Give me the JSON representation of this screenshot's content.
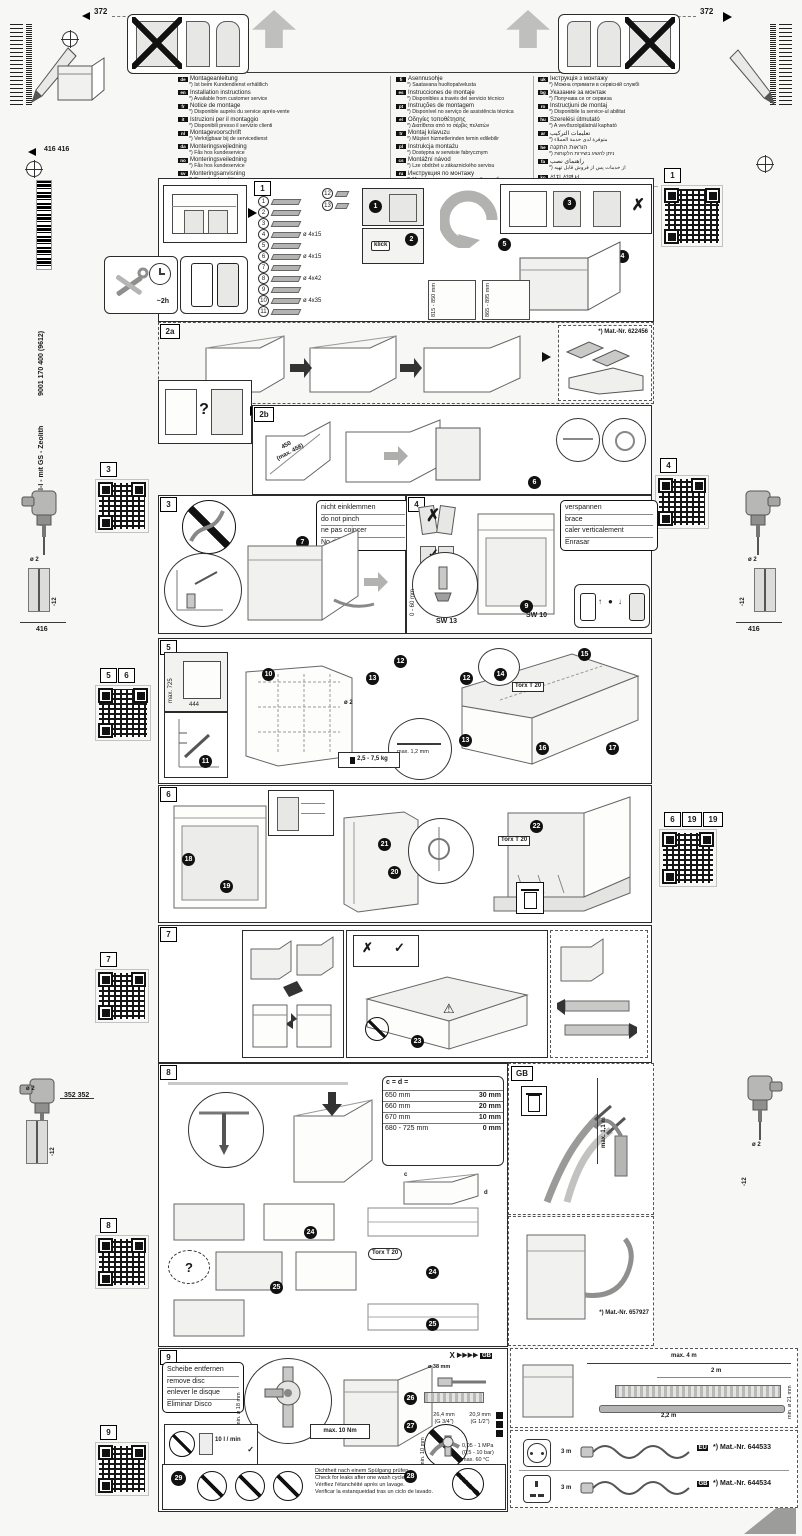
{
  "icons": {
    "x": "✗",
    "check": "✓",
    "play": "▶",
    "q": "?",
    "warn": "⚠",
    "up": "↑",
    "down": "↓",
    "dot": "●"
  },
  "header": {
    "dim_left": "372",
    "dim_right": "372"
  },
  "sidebar_left": {
    "dim_pair": "416 416",
    "product": "GV 440 Voll-I - mit GS - Zeolith",
    "docnum": "9001 170 400 (9612)",
    "drill1": {
      "dia": "ø 2",
      "depth": "-12",
      "base": "416"
    },
    "drill2": {
      "dia": "ø 2",
      "depth": "-12",
      "pair": "352 352"
    },
    "sq3": "3",
    "sq5": "5",
    "sq6": "6",
    "sq7": "7",
    "sq8": "8",
    "sq9": "9"
  },
  "sidebar_right": {
    "sq1": "1",
    "sq4": "4",
    "sq6": "6",
    "sq19a": "19",
    "sq19b": "19",
    "drill1": {
      "dia": "ø 2",
      "depth": "-12",
      "base": "416"
    },
    "drill2": {
      "dia": "ø 2",
      "depth": "-12"
    }
  },
  "languages": {
    "col1": [
      {
        "code": "de",
        "title": "Montageanleitung",
        "note": "*) Ist beim Kundendienst erhältlich"
      },
      {
        "code": "en",
        "title": "Installation instructions",
        "note": "*) Available from customer service"
      },
      {
        "code": "fr",
        "title": "Notice de montage",
        "note": "*) Disponible auprès du service après-vente"
      },
      {
        "code": "it",
        "title": "Istruzioni per il montaggio",
        "note": "*) Disponibili presso il servizio clienti"
      },
      {
        "code": "nl",
        "title": "Montagevoorschrift",
        "note": "*) Verkrijgbaar bij de servicedienst"
      },
      {
        "code": "da",
        "title": "Monteringsvejledning",
        "note": "*) Fås hos kundeservice"
      },
      {
        "code": "no",
        "title": "Monteringsveiledning",
        "note": "*) Fås hos kundeservice"
      },
      {
        "code": "sv",
        "title": "Monteringsanvisning",
        "note": "*) Finns hos kundtjänsten"
      }
    ],
    "col2": [
      {
        "code": "fi",
        "title": "Asennusohje",
        "note": "*) Saatavana huoltopalvelusta"
      },
      {
        "code": "es",
        "title": "Instrucciones de montaje",
        "note": "*) Disponibles a través del servicio técnico"
      },
      {
        "code": "pt",
        "title": "Instruções de montagem",
        "note": "*) Disponível no serviço de assistência técnica"
      },
      {
        "code": "el",
        "title": "Οδηγίες τοποθέτησης",
        "note": "*) Διατίθεται από το σέρβις πελατών"
      },
      {
        "code": "tr",
        "title": "Montaj kılavuzu",
        "note": "*) Müşteri hizmetlerinden temin edilebilir"
      },
      {
        "code": "pl",
        "title": "Instrukcja montażu",
        "note": "*) Dostępna w serwisie fabrycznym"
      },
      {
        "code": "cs",
        "title": "Montážní návod",
        "note": "*) Lze obdržet u zákaznického servisu"
      },
      {
        "code": "ru",
        "title": "Инструкция по монтажу",
        "note": "*) Можно получить в сервисной службе"
      }
    ],
    "col3": [
      {
        "code": "uk",
        "title": "Інструкція з монтажу",
        "note": "*) Можна отримати в сервісній службі"
      },
      {
        "code": "bg",
        "title": "Указание за монтаж",
        "note": "*) Получава се от сервиза"
      },
      {
        "code": "ro",
        "title": "Instrucţiuni de montaj",
        "note": "*) Disponibile la service-ul abilitat"
      },
      {
        "code": "hu",
        "title": "Szerelési útmutató",
        "note": "*) A vevőszolgálatnál kapható"
      },
      {
        "code": "ar",
        "title": "تعليمات التركيب",
        "note": "*) متوفرة لدى خدمة العملاء"
      },
      {
        "code": "he",
        "title": "הוראות התקנה",
        "note": "*) ניתן להשיג בשירות הלקוחות"
      },
      {
        "code": "fa",
        "title": "راهنمای نصب",
        "note": "*) از خدمات پس از فروش قابل تهیه"
      },
      {
        "code": "ko",
        "title": "설치 설명서",
        "note": "*) 고객 서비스 센터에서 구입 가능"
      },
      {
        "code": "zh",
        "title": "安装说明",
        "note": "*) 可向客户服务部门索取"
      },
      {
        "code": "ja",
        "title": "取付説明書",
        "note": "*) カスタマーサービスで入手可能"
      }
    ]
  },
  "steps": {
    "s1": {
      "label": "1",
      "time": "~2h",
      "klick": "klick",
      "dim_a": "815 - 850 mm",
      "dim_b": "865 - 895 mm",
      "parts": [
        {
          "n": "1",
          "screw": ""
        },
        {
          "n": "2",
          "screw": ""
        },
        {
          "n": "3",
          "screw": ""
        },
        {
          "n": "4",
          "screw": "ø 4x15"
        },
        {
          "n": "5",
          "screw": ""
        },
        {
          "n": "6",
          "screw": "ø 4x15"
        },
        {
          "n": "7",
          "screw": ""
        },
        {
          "n": "8",
          "screw": "ø 4x42"
        },
        {
          "n": "9",
          "screw": ""
        },
        {
          "n": "10",
          "screw": "ø 4x35"
        },
        {
          "n": "11",
          "screw": ""
        }
      ],
      "p12": "12",
      "p13": "13"
    },
    "s2a": {
      "label": "2a",
      "mat": "*) Mat.-Nr. 622456"
    },
    "s2b": {
      "label": "2b",
      "dim": "450",
      "dimmax": "(max. 458)"
    },
    "s3": {
      "label": "3",
      "note": [
        "nicht einklemmen",
        "do not pinch",
        "ne pas coincer",
        "No doblar"
      ]
    },
    "s4": {
      "label": "4",
      "note": [
        "verspannen",
        "brace",
        "caler verticalement",
        "Enrasar"
      ],
      "range": "0 - 60 mm",
      "sw13": "SW 13",
      "sw10": "SW 10"
    },
    "s5": {
      "label": "5",
      "max725": "max. 725",
      "dim444": "444",
      "dia": "ø 2",
      "maxgap": "max. 1,2 mm",
      "torx": "Torx T 20",
      "weight": "2,5 - 7,5 kg"
    },
    "s6": {
      "label": "6",
      "torx": "Torx T 20"
    },
    "s7": {
      "label": "7"
    },
    "s8": {
      "label": "8",
      "torx": "Torx T 20",
      "c": "c",
      "d": "d",
      "table": {
        "head": "c = d =",
        "rows": [
          [
            "650 mm",
            "30 mm"
          ],
          [
            "660 mm",
            "20 mm"
          ],
          [
            "670 mm",
            "10 mm"
          ],
          [
            "680 - 725 mm",
            "0 mm"
          ]
        ]
      }
    },
    "gb": {
      "label": "GB",
      "maxlen": "max. 1,1 m",
      "mat": "*) Mat.-Nr. 657927"
    },
    "s9": {
      "label": "9",
      "xmark": "X",
      "fwd": "▶▶▶▶",
      "gbtag": "GB",
      "note": [
        "Scheibe entfernen",
        "remove disc",
        "enlever le disque",
        "Eliminar Disco"
      ],
      "dia18": "min. ø 18 mm",
      "flow": "10 l / min",
      "torque": "max. 10 Nm",
      "dia38": "ø 38 mm",
      "g34": "26,4 mm",
      "g34b": "(G 3/4\")",
      "g12": "20,9 mm",
      "g12b": "(G 1/2\")",
      "min10": "min. 10 mm",
      "pressure": [
        "0,05 - 1 MPa",
        "(0,5 - 10 bar)",
        "max. 60 °C"
      ],
      "leak": [
        "Dichtheit nach einem Spülgang prüfen.",
        "Check for leaks after one wash cycle.",
        "Vérifiez l'étanchéité après un lavage.",
        "Verificar la estanqueidad tras un ciclo de lavado."
      ]
    },
    "bottom": {
      "max4": "max. 4 m",
      "d2": "2 m",
      "d22": "2,2 m",
      "dia21": "min. ø 21 mm",
      "rows": [
        {
          "len": "3 m",
          "code": "EU",
          "mat": "*) Mat.-Nr. 644533"
        },
        {
          "len": "3 m",
          "code": "GB",
          "mat": "*) Mat.-Nr. 644534"
        }
      ]
    }
  },
  "badges": {
    "b1": "1",
    "b2": "2",
    "b3": "3",
    "b4": "4",
    "b5": "5",
    "b6": "6",
    "b7": "7",
    "b8": "8",
    "b9": "9",
    "b10": "10",
    "b11": "11",
    "b12": "12",
    "b13": "13",
    "b14": "14",
    "b15": "15",
    "b16": "16",
    "b17": "17",
    "b18": "18",
    "b19": "19",
    "b20": "20",
    "b21": "21",
    "b22": "22",
    "b23": "23",
    "b24": "24",
    "b25": "25",
    "b26": "26",
    "b27": "27",
    "b28": "28",
    "b29": "29"
  }
}
